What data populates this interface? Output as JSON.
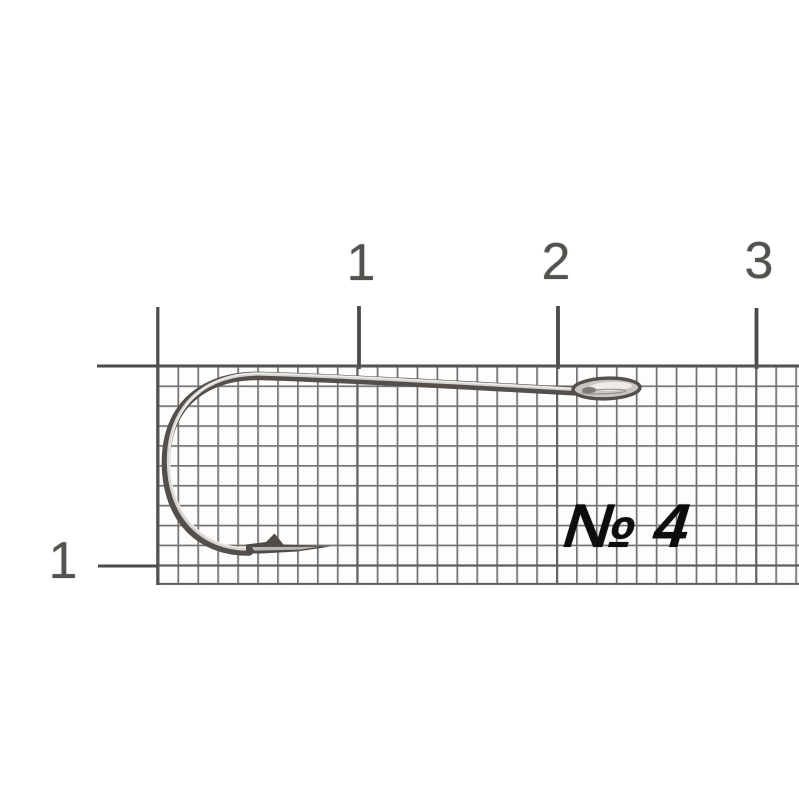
{
  "scene": {
    "type": "product-photo",
    "subject": "single fishing hook lying on millimeter graph paper with centimeter ruler marks",
    "background_color": "#ffffff",
    "grid_line_color": "#5f5f5f",
    "ruler_mark_color": "#4c4c4c",
    "label_text_color": "#53524f",
    "annotation_text_color": "#0d0d0d",
    "hook_metal_dark": "#544f4b",
    "hook_metal_mid": "#d7d4d0",
    "hook_metal_highlight": "#f3f1ee"
  },
  "ruler": {
    "unit_labels_top": [
      "1",
      "2",
      "3"
    ],
    "unit_label_left": "1"
  },
  "annotation": {
    "hook_size": "№ 4"
  }
}
